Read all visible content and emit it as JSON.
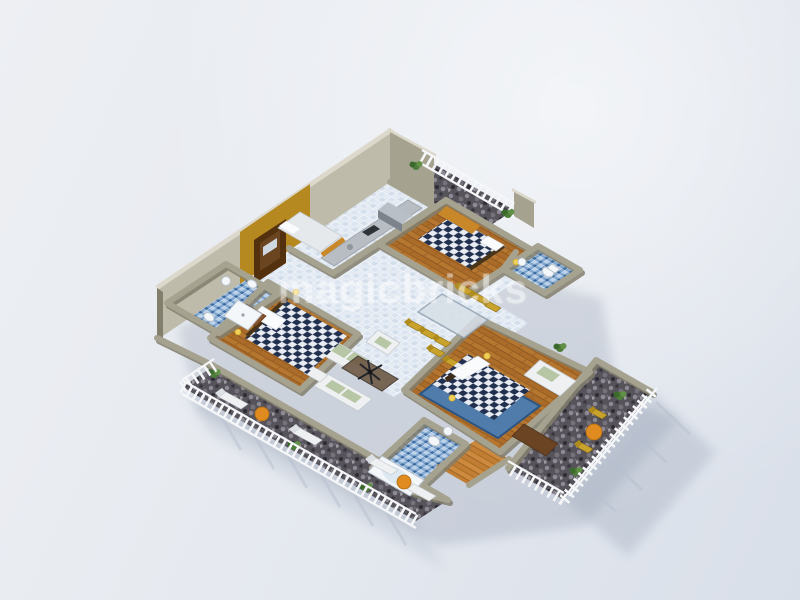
{
  "scene": {
    "title": "3D isometric floor plan render of a 3-bedroom apartment",
    "watermark": "magicbricks"
  },
  "rooms": {
    "entrance": "Entrance with wooden door",
    "kitchen": "Kitchen with counter",
    "utility_bed": "Single bed room beside kitchen",
    "balcony_ne": "Balcony north-east with railing",
    "bedroom2": "Bedroom 2 with checkered double bed",
    "bathroom2": "Bathroom 2 blue mosaic",
    "dining": "Dining area with glass table and yellow chairs",
    "living": "Living room with white and sage sofas",
    "bedroom1": "Bedroom 1 with checkered double bed",
    "bathroom1": "Bathroom 1 with shower, basin and toilets",
    "deck": "Long deck balcony south-west with loungers",
    "master_bedroom": "Master bedroom with checkered bed, blue rug and sofa",
    "master_bathroom": "Master bathroom with bathtub",
    "dressing": "Dressing passage wooden floor",
    "balcony_se": "Balcony south-east with yellow chairs"
  },
  "colors": {
    "background_top": "#edeff3",
    "background_bottom": "#d9dfe9",
    "wall": "#a6a290",
    "wall_light": "#bfbbaa",
    "wall_dark": "#837f6d",
    "wall_top_face": "#dcd9cc",
    "accent_mustard": "#b5891f",
    "door_brown": "#53310f",
    "floor_tile": "#e3eaf2",
    "floor_wood": "#b5762f",
    "floor_wood_light": "#cd8a3e",
    "floor_mosaic": "#7fa6d1",
    "floor_pebble": "#56535b",
    "bed_check_dark": "#22304f",
    "bed_check_light": "#e8ecf2",
    "sofa_white": "#eef0f2",
    "cushion_sage": "#b7c6a4",
    "accent_yellow": "#c9a22c",
    "accent_orange": "#e08b1f",
    "rug_blue": "#4f7cab",
    "railing_white": "#f5f6f8",
    "shadow": "#8d97ab",
    "watermark": "rgba(255,255,255,0.38)"
  }
}
